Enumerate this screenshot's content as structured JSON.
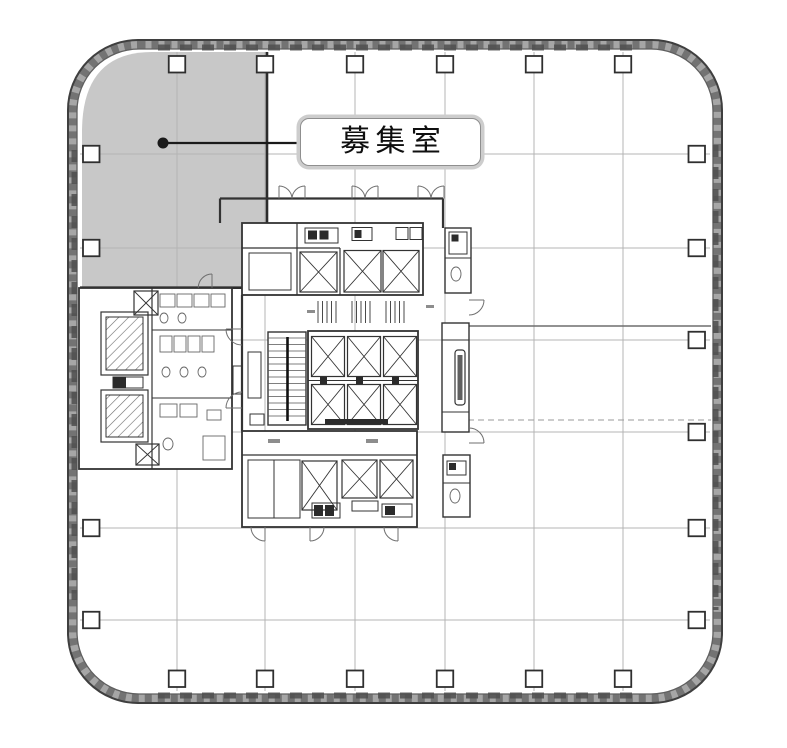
{
  "image": {
    "width": 787,
    "height": 748,
    "background": "#ffffff"
  },
  "floorplan": {
    "callout": {
      "text": "募集室"
    },
    "colors": {
      "available_fill": "#c8c8c8",
      "wall_dark": "#3f3f3f",
      "wall_mid": "#a6a6a6",
      "grid_line": "#b4b4b4",
      "core_line": "#333333",
      "callout_border": "#8f8f8f",
      "callout_halo": "#cdcdcd",
      "callout_text": "#0f0f0f",
      "leader": "#1a1a1a"
    }
  }
}
